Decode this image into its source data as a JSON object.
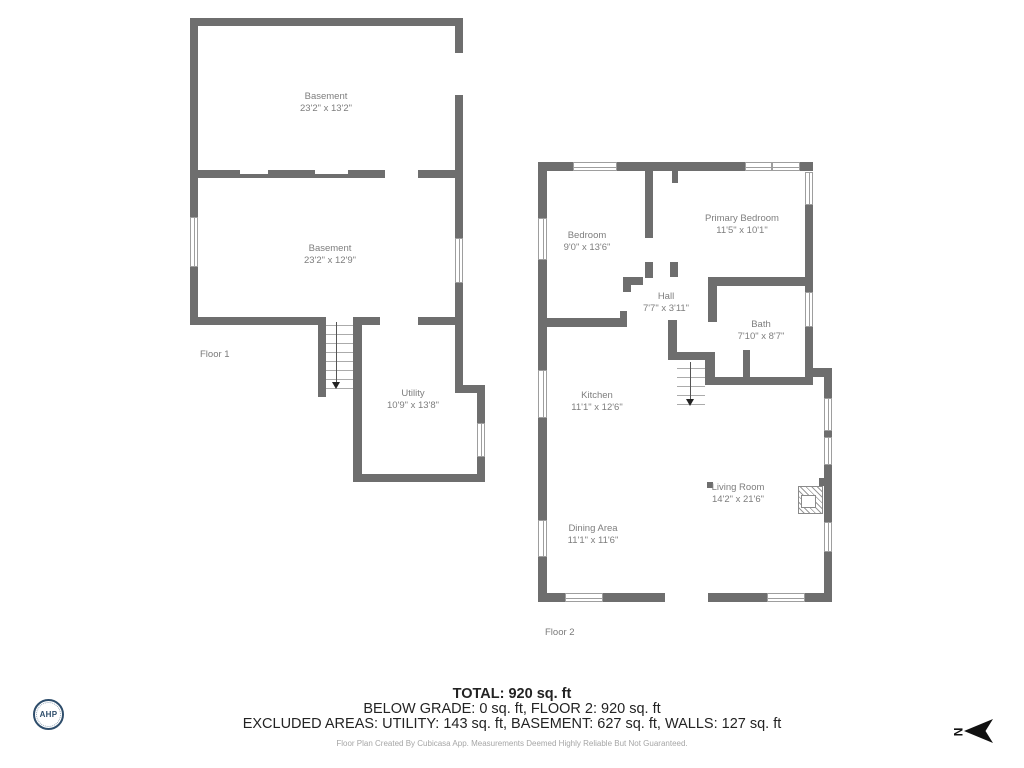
{
  "floor1": {
    "label": "Floor 1",
    "rooms": {
      "basement_upper": {
        "name": "Basement",
        "dims": "23'2\" x 13'2\""
      },
      "basement_lower": {
        "name": "Basement",
        "dims": "23'2\" x 12'9\""
      },
      "utility": {
        "name": "Utility",
        "dims": "10'9\" x 13'8\""
      }
    }
  },
  "floor2": {
    "label": "Floor 2",
    "rooms": {
      "bedroom": {
        "name": "Bedroom",
        "dims": "9'0\" x 13'6\""
      },
      "primary_bedroom": {
        "name": "Primary Bedroom",
        "dims": "11'5\" x 10'1\""
      },
      "hall": {
        "name": "Hall",
        "dims": "7'7\" x 3'11\""
      },
      "bath": {
        "name": "Bath",
        "dims": "7'10\" x 8'7\""
      },
      "kitchen": {
        "name": "Kitchen",
        "dims": "11'1\" x 12'6\""
      },
      "living_room": {
        "name": "Living Room",
        "dims": "14'2\" x 21'6\""
      },
      "dining_area": {
        "name": "Dining Area",
        "dims": "11'1\" x 11'6\""
      }
    }
  },
  "summary": {
    "total": "TOTAL: 920 sq. ft",
    "grade_line": "BELOW GRADE: 0 sq. ft, FLOOR 2: 920 sq. ft",
    "excluded_line": "EXCLUDED AREAS: UTILITY: 143 sq. ft, BASEMENT: 627 sq. ft, WALLS: 127 sq. ft",
    "disclaimer": "Floor Plan Created By Cubicasa App. Measurements Deemed Highly Reliable But Not Guaranteed."
  },
  "branding": {
    "logo_text": "AHP"
  },
  "compass": {
    "north_label": "N"
  },
  "colors": {
    "wall": "#6e6e6e",
    "room_label": "#7e7e7e",
    "summary_text": "#232323",
    "disclaimer_text": "#a6a6a6",
    "logo_navy": "#2e4d6b",
    "arrow_black": "#111111"
  }
}
